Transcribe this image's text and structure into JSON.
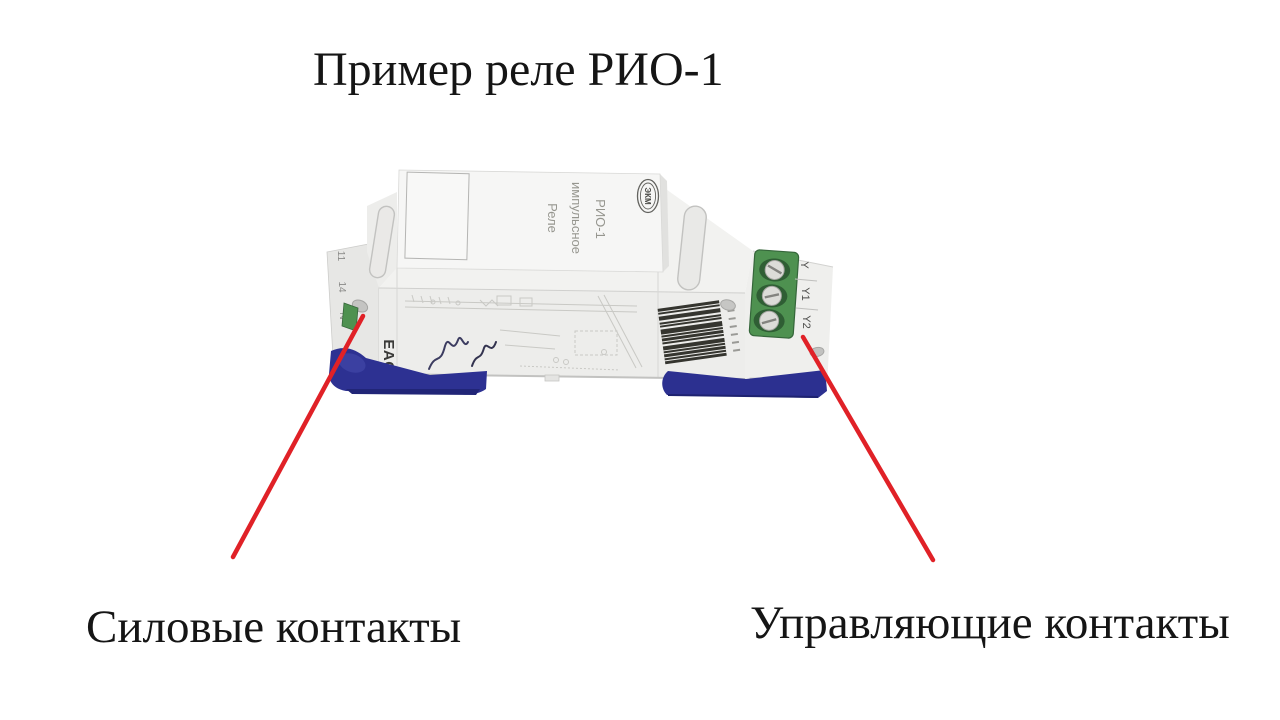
{
  "title": {
    "text": "Пример реле РИО-1"
  },
  "callouts": {
    "left": {
      "label": "Силовые контакты"
    },
    "right": {
      "label": "Управляющие контакты"
    }
  },
  "device": {
    "top_text": {
      "lines": [
        "Реле",
        "импульсное",
        "РИО-1"
      ]
    },
    "brand": "ЭКМ",
    "cert_mark": "EAC",
    "right_terminal_labels": [
      "Y",
      "Y1",
      "Y2"
    ],
    "left_terminal_labels": [
      "11",
      "14",
      "N"
    ]
  },
  "colors": {
    "accent_red": "#e02127",
    "clip_blue": "#2d3192",
    "clip_blue_right": "#2c3090",
    "terminal_green": "#4e9150",
    "text_black": "#151515"
  }
}
